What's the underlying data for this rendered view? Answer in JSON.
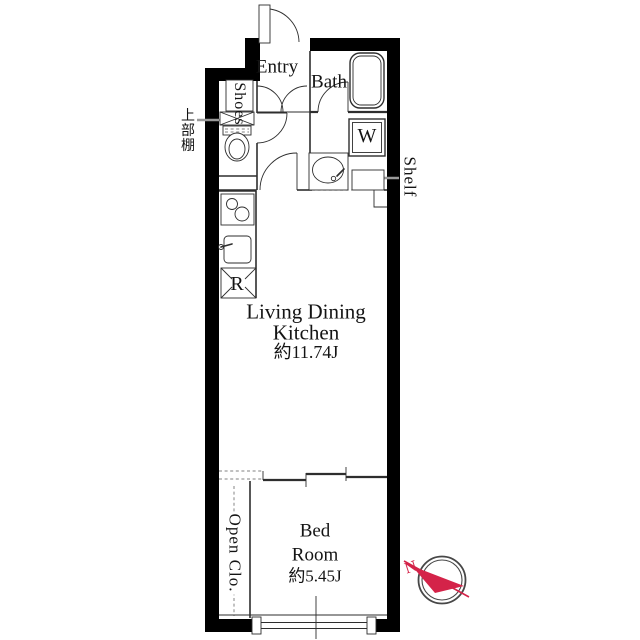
{
  "title": "Apartment floor plan",
  "colors": {
    "wall": "#000000",
    "line": "#2e2e2e",
    "line_light": "#9a9a9a",
    "accent_red": "#d42349",
    "paper": "#ffffff"
  },
  "rooms": {
    "entry": {
      "name": "Entry"
    },
    "bath": {
      "name": "Bath"
    },
    "ldk": {
      "name_line1": "Living Dining",
      "name_line2": "Kitchen",
      "area": "約11.74J"
    },
    "bedroom": {
      "name_line1": "Bed",
      "name_line2": "Room",
      "area": "約5.45J"
    }
  },
  "fixtures": {
    "washing_machine": "W",
    "refrigerator": "R",
    "shoes_cabinet": "Shoes",
    "shelf": "Shelf",
    "upper_shelf": "上部棚",
    "open_closet": "Open Clo."
  },
  "compass": {
    "north": "N"
  }
}
